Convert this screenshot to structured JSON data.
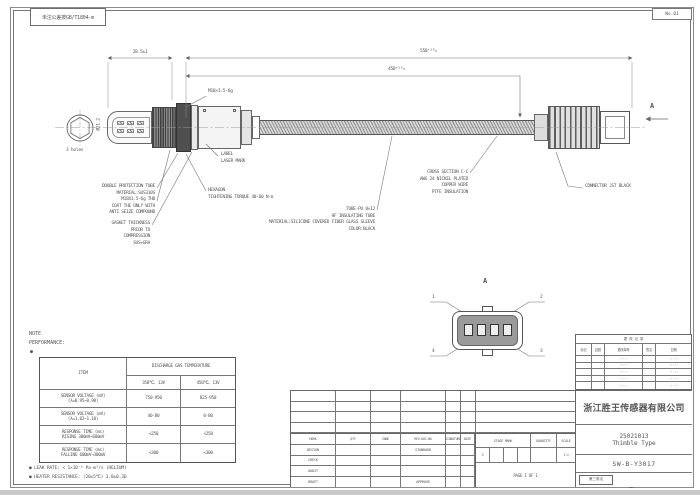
{
  "colors": {
    "line": "#777777",
    "dark": "#4a4a4a",
    "text": "#555555"
  },
  "stamp": {
    "text": "未注公差按GB/T1804-m"
  },
  "sheet_no": {
    "text": "No.01"
  },
  "dims": {
    "d1": "28.5±1",
    "overall": "550⁺⁵⁰₀",
    "cable": "450⁺⁵⁰₀",
    "thread": "M18×1.5-6g",
    "tube_dia": "Ø21.2",
    "hex_note": "3 holes",
    "section": "A"
  },
  "callouts": {
    "protection": [
      "DOUBLE PROTECTION TUBE",
      "MATERIAL:SUS310S"
    ],
    "thread_note": [
      "M18X1.5-6g THD",
      "COAT THE ONLY WITH",
      "ANTI SEIZE COMPOUND"
    ],
    "gasket": [
      "GASKET THICKNESS",
      "PRIOR TO",
      "COMPRESSION",
      "SUS+GRA"
    ],
    "label": [
      "LABEL",
      "LASER MARK"
    ],
    "hexagon": [
      "HEXAGON",
      "TIGHTENING TORQUE 40-60 N·m"
    ],
    "sleeve": [
      "TUBE-PU 8×12",
      "HF INSULATING TUBE",
      "MATERIAL:SILICONE COVERED FIBER GLASS SLEEVE",
      "COLOR:BLACK"
    ],
    "wire": [
      "CROSS SECTION C-C",
      "AWG 24 NICKEL PLATED",
      "COPPER WIRE",
      "PTFE INSULATION"
    ],
    "connector": "CONNECTOR JST BLACK"
  },
  "detail": {
    "label": "A",
    "pins": [
      "1",
      "2",
      "3",
      "4"
    ]
  },
  "note": {
    "title": "NOTE",
    "subtitle": "PERFORMANCE:",
    "bullet": "●"
  },
  "perf_table": {
    "item_header": "ITEM",
    "group_header": "DISCHARGE GAS TEMPERATURE",
    "sub1": "350℃、13V",
    "sub2": "450℃、13V",
    "rows": [
      {
        "l1": "SENSOR VOLTAGE (mV)",
        "l2": "(λ=0.95~0.98)",
        "v1": "750-950",
        "v2": "825-950"
      },
      {
        "l1": "SENSOR VOLTAGE (mV)",
        "l2": "(λ=1.02~1.10)",
        "v1": "40-80",
        "v2": "0-80"
      },
      {
        "l1": "RESPONSE TIME (ms)",
        "l2": "RISING 300mV→600mV",
        "v1": "<250",
        "v2": "<250"
      },
      {
        "l1": "RESPONSE TIME (ms)",
        "l2": "FALLING 600mV→300mV",
        "v1": "<300",
        "v2": "<300"
      }
    ]
  },
  "foot_notes": {
    "leak": "● LEAK RATE: < 1×10⁻⁶ Pa·m³/s (HELIUM)",
    "heater": "● HEATER RESISTANCE: (20±5℃) 3.0±0.3Ω"
  },
  "revision_table": {
    "header": "更 改 记 录",
    "cols": [
      "标记",
      "处数",
      "更改单号",
      "签名",
      "日期"
    ],
    "rows": [
      [
        "",
        "",
        "·····",
        "",
        "·····"
      ],
      [
        "",
        "",
        "·····",
        "",
        "·····"
      ],
      [
        "",
        "",
        "·····",
        "",
        "·····"
      ],
      [
        "",
        "",
        "·····",
        "",
        "·····"
      ],
      [
        "",
        "",
        "·····",
        "",
        "·····"
      ]
    ]
  },
  "title_block": {
    "header_cells": [
      "MARK",
      "QTY",
      "ZONE",
      "REV.DOC.NO",
      "SIGNATURE",
      "DATE"
    ],
    "sign_rows": [
      {
        "role": "DESIGN",
        "role2": "STANDARD"
      },
      {
        "role": "CHECK",
        "role2": ""
      },
      {
        "role": "AUDIT",
        "role2": ""
      },
      {
        "role": "DRAFT",
        "role2": "APPROVE"
      }
    ],
    "stage_mark": "STAGE MARK",
    "quantity": "QUANTITY",
    "scale": "SCALE",
    "stage_val": "S",
    "scale_val": "1:1",
    "page": "PAGE 1 OF 1",
    "company": "浙江胜王传感器有限公司",
    "model": "25021013",
    "product_type": "Thimble Type",
    "drawing_no": "SW-B-Y3017",
    "projection": "第三角法"
  }
}
